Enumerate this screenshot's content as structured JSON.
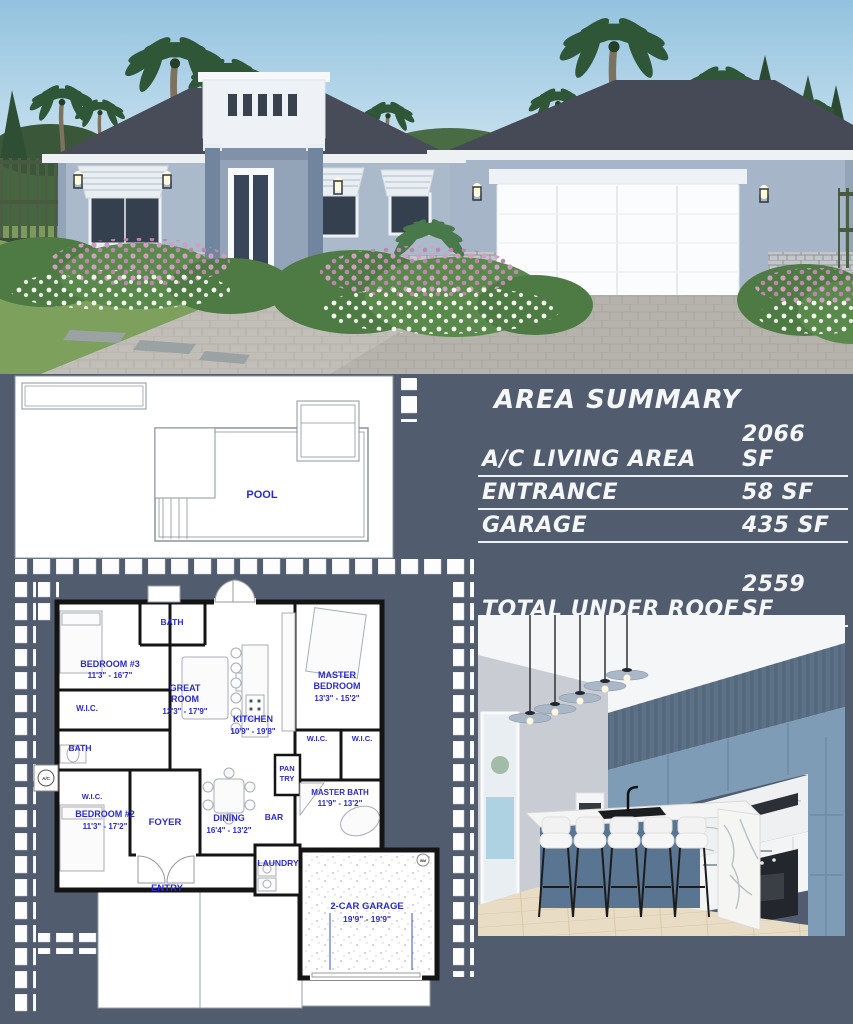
{
  "palette": {
    "background": "#515c6e",
    "plan_text_blue": "#2b2bd0",
    "summary_text": "#f4f6f8",
    "roof": "#474c58",
    "house_wall": "#abbacb"
  },
  "area_summary": {
    "title": "AREA SUMMARY",
    "rows": [
      {
        "label": "A/C LIVING AREA",
        "value": "2066 SF"
      },
      {
        "label": "ENTRANCE",
        "value": "58 SF"
      },
      {
        "label": "GARAGE",
        "value": "435 SF"
      }
    ],
    "total_label": "TOTAL UNDER ROOF",
    "total_value": "2559 SF"
  },
  "pool_plan": {
    "pool": "POOL"
  },
  "floor_plan": {
    "bedroom3_name": "BEDROOM #3",
    "bedroom3_dims": "11'3\" - 16'7\"",
    "bath": "BATH",
    "wic": "W.I.C.",
    "great_room_name1": "GREAT",
    "great_room_name2": "ROOM",
    "great_room_dims": "12'3\" - 17'9\"",
    "kitchen_name": "KITCHEN",
    "kitchen_dims": "10'9\" - 19'8\"",
    "master_bedroom_name1": "MASTER",
    "master_bedroom_name2": "BEDROOM",
    "master_bedroom_dims": "13'3\" - 15'2\"",
    "pantry1": "PAN",
    "pantry2": "TRY",
    "master_bath_name": "MASTER BATH",
    "master_bath_dims": "11'9\" - 13'2\"",
    "bar": "BAR",
    "bedroom2_name": "BEDROOM #2",
    "bedroom2_dims": "11'3\" - 17'2\"",
    "foyer": "FOYER",
    "dining_name": "DINING",
    "dining_dims": "16'4\" - 13'2\"",
    "entry": "ENTRY",
    "laundry": "LAUNDRY",
    "garage_name": "2-CAR GARAGE",
    "garage_dims": "19'9\" - 19'9\"",
    "ac": "A/C",
    "wm": "WM"
  }
}
